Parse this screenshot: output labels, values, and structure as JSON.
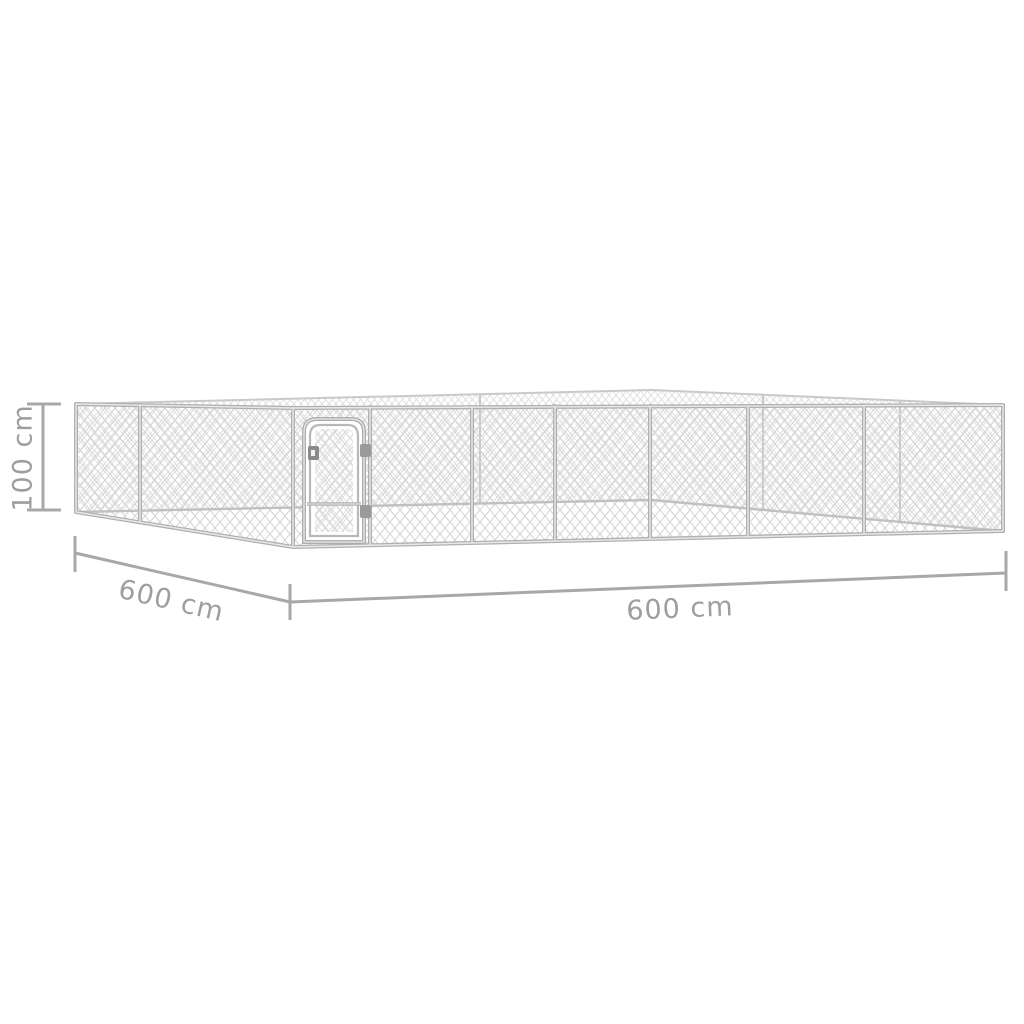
{
  "illustration": {
    "subject": "outdoor-chain-link-dog-kennel-perspective-drawing",
    "frame_color": "#b0b0b0",
    "frame_highlight_color": "#e9e9e9",
    "mesh_color": "#d5d5d5",
    "back_structure_color": "#c9c9c9",
    "dimension_line_color": "#a8a8a8",
    "label_color": "#9e9e9e",
    "background_color": "#ffffff"
  },
  "dimensions": {
    "height": {
      "label": "100 cm"
    },
    "depth": {
      "label": "600 cm"
    },
    "width": {
      "label": "600 cm"
    }
  }
}
